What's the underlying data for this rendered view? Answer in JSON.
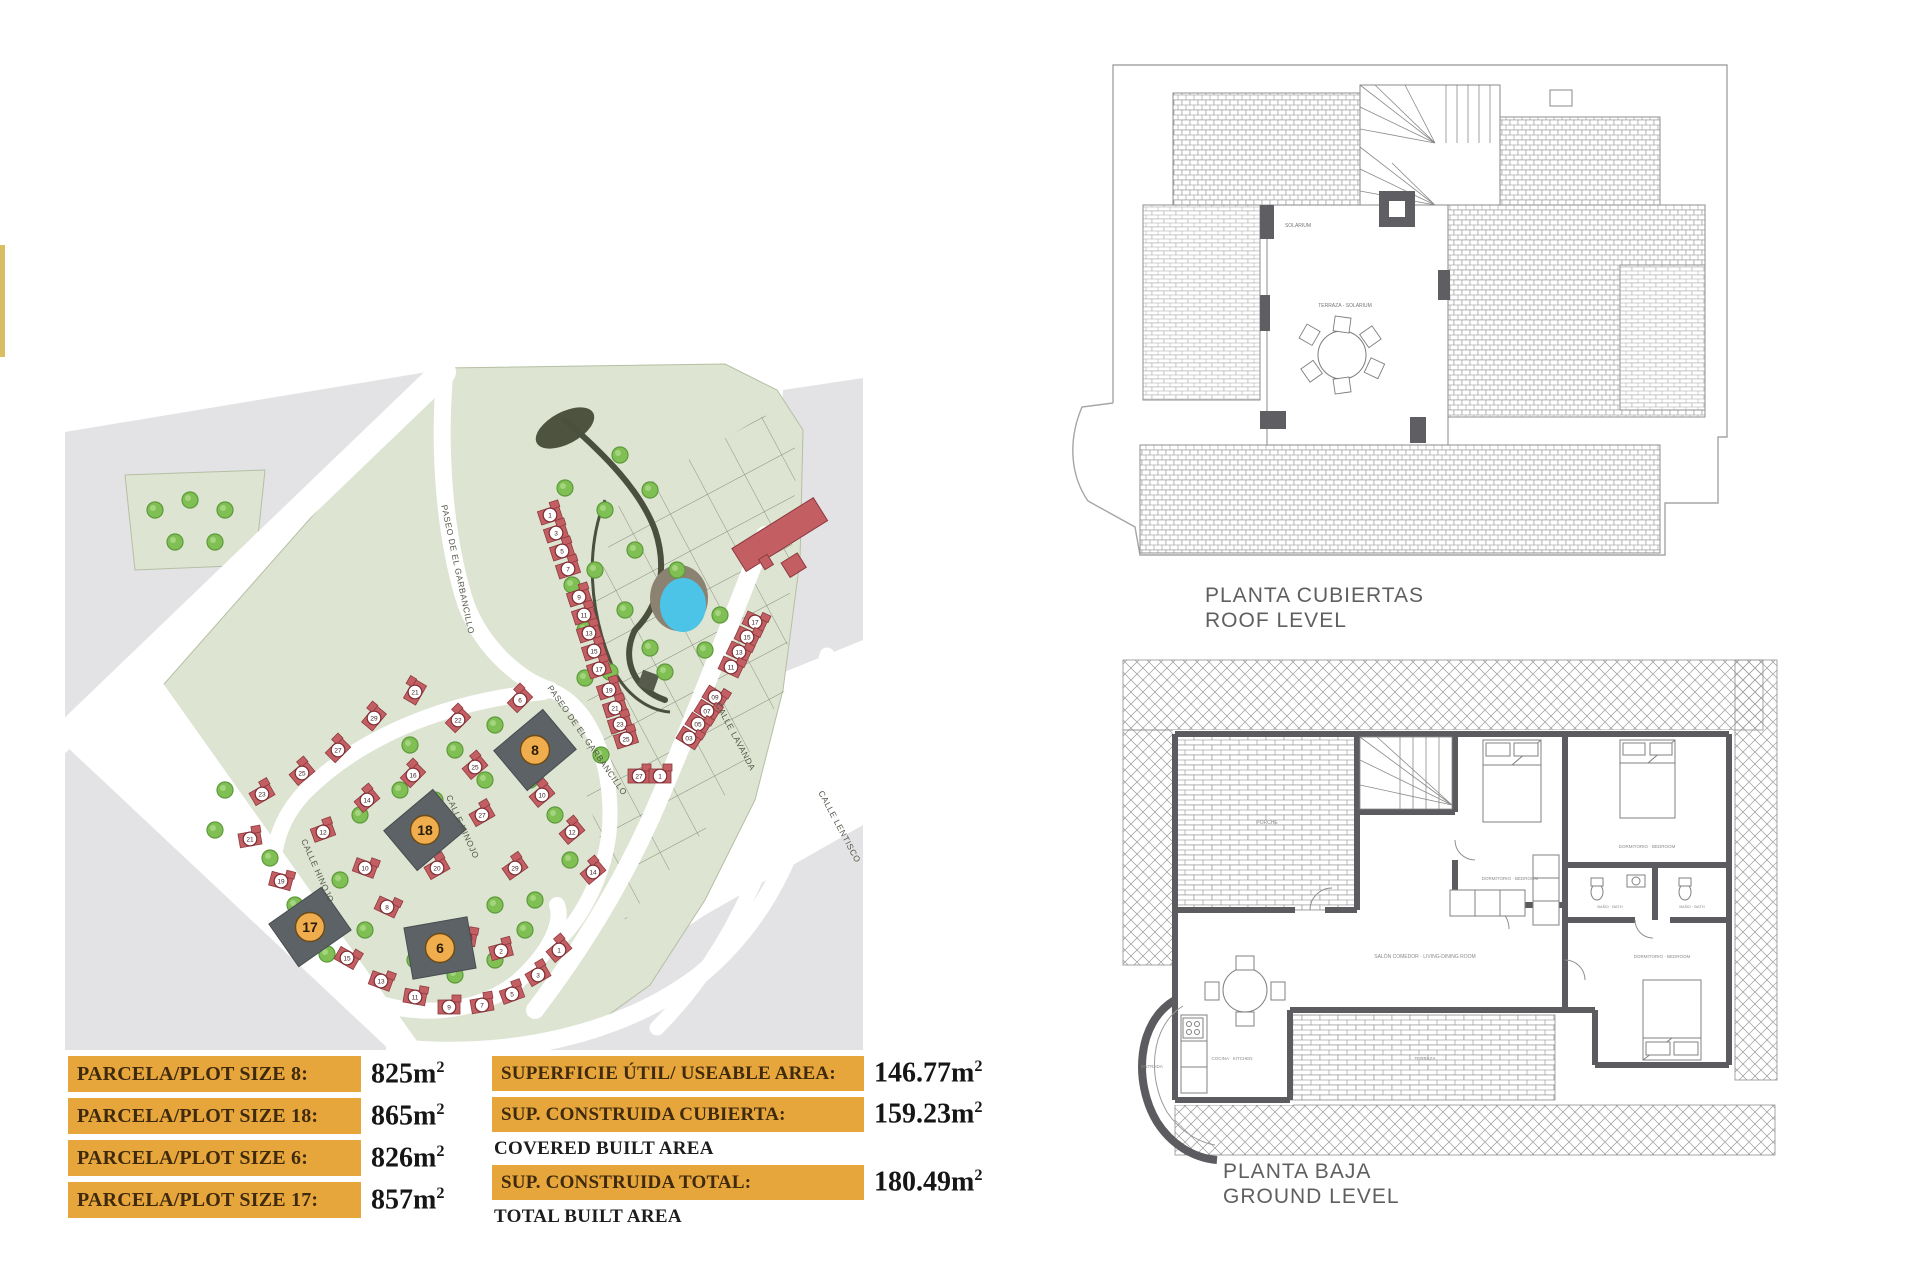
{
  "page": {
    "background": "#ffffff"
  },
  "left_strip": {
    "color": "#d9bd62"
  },
  "site_plan": {
    "colors": {
      "green": "#dde4d2",
      "green_border": "#b5bfa3",
      "gray": "#e3e3e5",
      "road": "#ffffff",
      "house_red": "#c35f63",
      "house_red_border": "#8d3a3f",
      "number_circle_fill": "#ffffff",
      "number_circle_border": "#7d2d33",
      "number_text": "#3a1d1f",
      "plot_dark": "#5c6266",
      "plot_circle": "#efad4e",
      "plot_circle_border": "#6b4a16",
      "tree": "#7fbf54",
      "tree_border": "#5c9a3a",
      "pond": "#4cc4e8",
      "pond_bank": "#8b8272",
      "park_path": "#4a4f3e",
      "label_color": "#55584a"
    },
    "street_labels": [
      {
        "text": "PASEO DE EL GARBANCILLO",
        "x": 390,
        "y": 210,
        "angle": 78
      },
      {
        "text": "PASEO DE EL GARBANCILLO",
        "x": 520,
        "y": 382,
        "angle": 55
      },
      {
        "text": "CALLE HINOJO",
        "x": 250,
        "y": 512,
        "angle": 66
      },
      {
        "text": "CALLE HINOJO",
        "x": 395,
        "y": 468,
        "angle": 66
      },
      {
        "text": "CALLE LAVANDA",
        "x": 668,
        "y": 378,
        "angle": 62
      },
      {
        "text": "CALLE LENTISCO",
        "x": 772,
        "y": 468,
        "angle": 62
      }
    ],
    "highlight_plots": [
      {
        "number": "8",
        "x": 470,
        "y": 390,
        "angle": -40
      },
      {
        "number": "18",
        "x": 360,
        "y": 470,
        "angle": -40
      },
      {
        "number": "6",
        "x": 375,
        "y": 588,
        "angle": -10
      },
      {
        "number": "17",
        "x": 245,
        "y": 567,
        "angle": -35
      }
    ],
    "houses": [
      {
        "n": "1",
        "x": 485,
        "y": 155,
        "a": -18
      },
      {
        "n": "3",
        "x": 491,
        "y": 173,
        "a": -18
      },
      {
        "n": "5",
        "x": 497,
        "y": 191,
        "a": -18
      },
      {
        "n": "7",
        "x": 503,
        "y": 209,
        "a": -18
      },
      {
        "n": "9",
        "x": 514,
        "y": 237,
        "a": -18
      },
      {
        "n": "11",
        "x": 519,
        "y": 255,
        "a": -18
      },
      {
        "n": "13",
        "x": 524,
        "y": 273,
        "a": -18
      },
      {
        "n": "15",
        "x": 529,
        "y": 291,
        "a": -18
      },
      {
        "n": "17",
        "x": 534,
        "y": 309,
        "a": -18
      },
      {
        "n": "19",
        "x": 544,
        "y": 330,
        "a": -18
      },
      {
        "n": "21",
        "x": 550,
        "y": 348,
        "a": -18
      },
      {
        "n": "23",
        "x": 555,
        "y": 364,
        "a": -18
      },
      {
        "n": "25",
        "x": 561,
        "y": 379,
        "a": -18
      },
      {
        "n": "27",
        "x": 574,
        "y": 416,
        "a": 0
      },
      {
        "n": "1",
        "x": 595,
        "y": 416,
        "a": 0
      },
      {
        "n": "17",
        "x": 690,
        "y": 262,
        "a": 25
      },
      {
        "n": "15",
        "x": 682,
        "y": 277,
        "a": 25
      },
      {
        "n": "13",
        "x": 674,
        "y": 292,
        "a": 25
      },
      {
        "n": "11",
        "x": 666,
        "y": 307,
        "a": 25
      },
      {
        "n": "09",
        "x": 650,
        "y": 337,
        "a": 32
      },
      {
        "n": "07",
        "x": 642,
        "y": 351,
        "a": 32
      },
      {
        "n": "05",
        "x": 633,
        "y": 364,
        "a": 32
      },
      {
        "n": "03",
        "x": 624,
        "y": 378,
        "a": 32
      },
      {
        "n": "21",
        "x": 350,
        "y": 332,
        "a": -60
      },
      {
        "n": "29",
        "x": 309,
        "y": 358,
        "a": -50
      },
      {
        "n": "27",
        "x": 273,
        "y": 390,
        "a": -45
      },
      {
        "n": "25",
        "x": 237,
        "y": 413,
        "a": -40
      },
      {
        "n": "23",
        "x": 197,
        "y": 434,
        "a": -30
      },
      {
        "n": "21",
        "x": 185,
        "y": 479,
        "a": -10
      },
      {
        "n": "19",
        "x": 216,
        "y": 521,
        "a": 15
      },
      {
        "n": "15",
        "x": 282,
        "y": 598,
        "a": 30
      },
      {
        "n": "13",
        "x": 316,
        "y": 621,
        "a": 20
      },
      {
        "n": "11",
        "x": 350,
        "y": 637,
        "a": 10
      },
      {
        "n": "9",
        "x": 384,
        "y": 647,
        "a": 0
      },
      {
        "n": "7",
        "x": 417,
        "y": 645,
        "a": -10
      },
      {
        "n": "5",
        "x": 447,
        "y": 634,
        "a": -20
      },
      {
        "n": "3",
        "x": 473,
        "y": 615,
        "a": -30
      },
      {
        "n": "1",
        "x": 494,
        "y": 590,
        "a": -40
      },
      {
        "n": "16",
        "x": 348,
        "y": 415,
        "a": -45
      },
      {
        "n": "14",
        "x": 302,
        "y": 440,
        "a": -40
      },
      {
        "n": "12",
        "x": 258,
        "y": 472,
        "a": -20
      },
      {
        "n": "10",
        "x": 300,
        "y": 508,
        "a": 20
      },
      {
        "n": "8",
        "x": 322,
        "y": 547,
        "a": 25
      },
      {
        "n": "20",
        "x": 372,
        "y": 508,
        "a": -30
      },
      {
        "n": "4",
        "x": 400,
        "y": 578,
        "a": 10
      },
      {
        "n": "2",
        "x": 436,
        "y": 591,
        "a": -15
      },
      {
        "n": "22",
        "x": 393,
        "y": 360,
        "a": -45
      },
      {
        "n": "25",
        "x": 410,
        "y": 407,
        "a": -40
      },
      {
        "n": "27",
        "x": 417,
        "y": 455,
        "a": -30
      },
      {
        "n": "29",
        "x": 450,
        "y": 508,
        "a": -35
      },
      {
        "n": "6",
        "x": 455,
        "y": 340,
        "a": -45
      },
      {
        "n": "10",
        "x": 477,
        "y": 435,
        "a": -40
      },
      {
        "n": "12",
        "x": 507,
        "y": 472,
        "a": -40
      },
      {
        "n": "14",
        "x": 528,
        "y": 512,
        "a": -40
      }
    ],
    "trees": [
      {
        "x": 90,
        "y": 150
      },
      {
        "x": 125,
        "y": 140
      },
      {
        "x": 160,
        "y": 150
      },
      {
        "x": 110,
        "y": 182
      },
      {
        "x": 150,
        "y": 182
      },
      {
        "x": 500,
        "y": 128
      },
      {
        "x": 507,
        "y": 225
      },
      {
        "x": 520,
        "y": 318
      },
      {
        "x": 536,
        "y": 395
      },
      {
        "x": 555,
        "y": 95
      },
      {
        "x": 585,
        "y": 130
      },
      {
        "x": 540,
        "y": 150
      },
      {
        "x": 570,
        "y": 190
      },
      {
        "x": 560,
        "y": 250
      },
      {
        "x": 530,
        "y": 210
      },
      {
        "x": 585,
        "y": 288
      },
      {
        "x": 640,
        "y": 290
      },
      {
        "x": 655,
        "y": 255
      },
      {
        "x": 600,
        "y": 312
      },
      {
        "x": 545,
        "y": 312
      },
      {
        "x": 520,
        "y": 270
      },
      {
        "x": 160,
        "y": 430
      },
      {
        "x": 150,
        "y": 470
      },
      {
        "x": 230,
        "y": 545
      },
      {
        "x": 262,
        "y": 594
      },
      {
        "x": 295,
        "y": 455
      },
      {
        "x": 335,
        "y": 430
      },
      {
        "x": 370,
        "y": 440
      },
      {
        "x": 420,
        "y": 420
      },
      {
        "x": 300,
        "y": 570
      },
      {
        "x": 350,
        "y": 600
      },
      {
        "x": 390,
        "y": 615
      },
      {
        "x": 430,
        "y": 600
      },
      {
        "x": 460,
        "y": 570
      },
      {
        "x": 345,
        "y": 385
      },
      {
        "x": 390,
        "y": 390
      },
      {
        "x": 430,
        "y": 365
      },
      {
        "x": 465,
        "y": 420
      },
      {
        "x": 490,
        "y": 455
      },
      {
        "x": 505,
        "y": 500
      },
      {
        "x": 470,
        "y": 540
      },
      {
        "x": 205,
        "y": 498
      },
      {
        "x": 275,
        "y": 520
      },
      {
        "x": 430,
        "y": 545
      },
      {
        "x": 612,
        "y": 210
      }
    ]
  },
  "roof_plan": {
    "title_line1": "PLANTA CUBIERTAS",
    "title_line2": "ROOF LEVEL",
    "area_labels": [
      {
        "text": "SOLARIUM",
        "x": 368,
        "y": 172
      },
      {
        "text": "TERRAZA - SOLARIUM",
        "x": 415,
        "y": 252
      }
    ]
  },
  "ground_plan": {
    "title_line1": "PLANTA BAJA",
    "title_line2": "GROUND LEVEL",
    "room_labels": [
      {
        "text": "PORCHE",
        "x": 172,
        "y": 264,
        "s": 5
      },
      {
        "text": "SALÓN COMEDOR · LIVING-DINING ROOM",
        "x": 330,
        "y": 398,
        "s": 5
      },
      {
        "text": "COCINA · KITCHEN",
        "x": 137,
        "y": 500,
        "s": 4.5
      },
      {
        "text": "DORMITORIO · BEDROOM",
        "x": 415,
        "y": 320,
        "s": 4.5
      },
      {
        "text": "DORMITORIO · BEDROOM",
        "x": 552,
        "y": 288,
        "s": 4.5
      },
      {
        "text": "DORMITORIO · BEDROOM",
        "x": 567,
        "y": 398,
        "s": 4.5
      },
      {
        "text": "BAÑO · BATH",
        "x": 515,
        "y": 348,
        "s": 4
      },
      {
        "text": "BAÑO · BATH",
        "x": 597,
        "y": 348,
        "s": 4
      },
      {
        "text": "ENTRADA",
        "x": 57,
        "y": 508,
        "s": 4.5
      },
      {
        "text": "TERRAZA",
        "x": 330,
        "y": 500,
        "s": 4.5
      }
    ]
  },
  "tables": {
    "unit_base": "m",
    "unit_sup": "2",
    "plot_sizes": {
      "rows": [
        {
          "label": "PARCELA/PLOT SIZE 8:",
          "value": "825"
        },
        {
          "label": "PARCELA/PLOT SIZE 18:",
          "value": "865"
        },
        {
          "label": "PARCELA/PLOT SIZE 6:",
          "value": "826"
        },
        {
          "label": "PARCELA/PLOT SIZE 17:",
          "value": "857"
        }
      ]
    },
    "areas": {
      "rows": [
        {
          "label": "SUPERFICIE ÚTIL/ USEABLE AREA:",
          "value": "146.77",
          "sub": null
        },
        {
          "label": "SUP. CONSTRUIDA CUBIERTA:",
          "value": "159.23",
          "sub": "COVERED BUILT AREA"
        },
        {
          "label": "SUP. CONSTRUIDA TOTAL:",
          "value": "180.49",
          "sub": "TOTAL BUILT AREA"
        }
      ]
    }
  }
}
